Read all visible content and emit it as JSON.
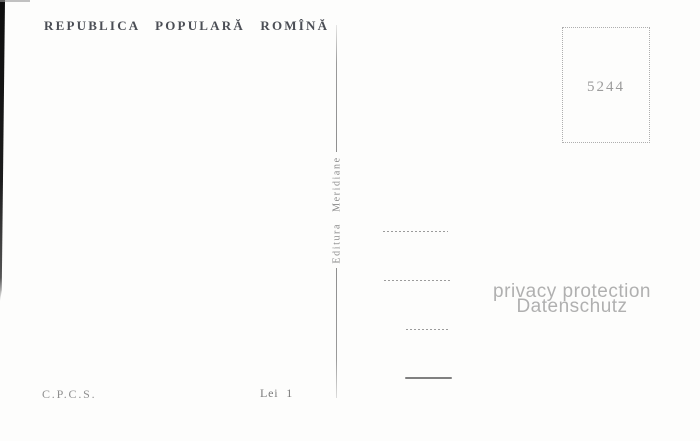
{
  "postcard": {
    "header": {
      "country_title": "REPUBLICA POPULARĂ ROMÎNĂ"
    },
    "stamp_box": {
      "number": "5244"
    },
    "publisher": {
      "label": "Editura Meridiane"
    },
    "watermark": {
      "line1": "privacy protection",
      "line2": "Datenschutz"
    },
    "footer": {
      "agency": "C.P.C.S.",
      "price": "Lei 1"
    }
  },
  "colors": {
    "paper": "#fdfdfc",
    "title": "#4b4e55",
    "muted": "#8a8a8a",
    "faint": "#9c9c9c",
    "line": "#a0a0a0",
    "watermark": "#b0b0b0"
  }
}
